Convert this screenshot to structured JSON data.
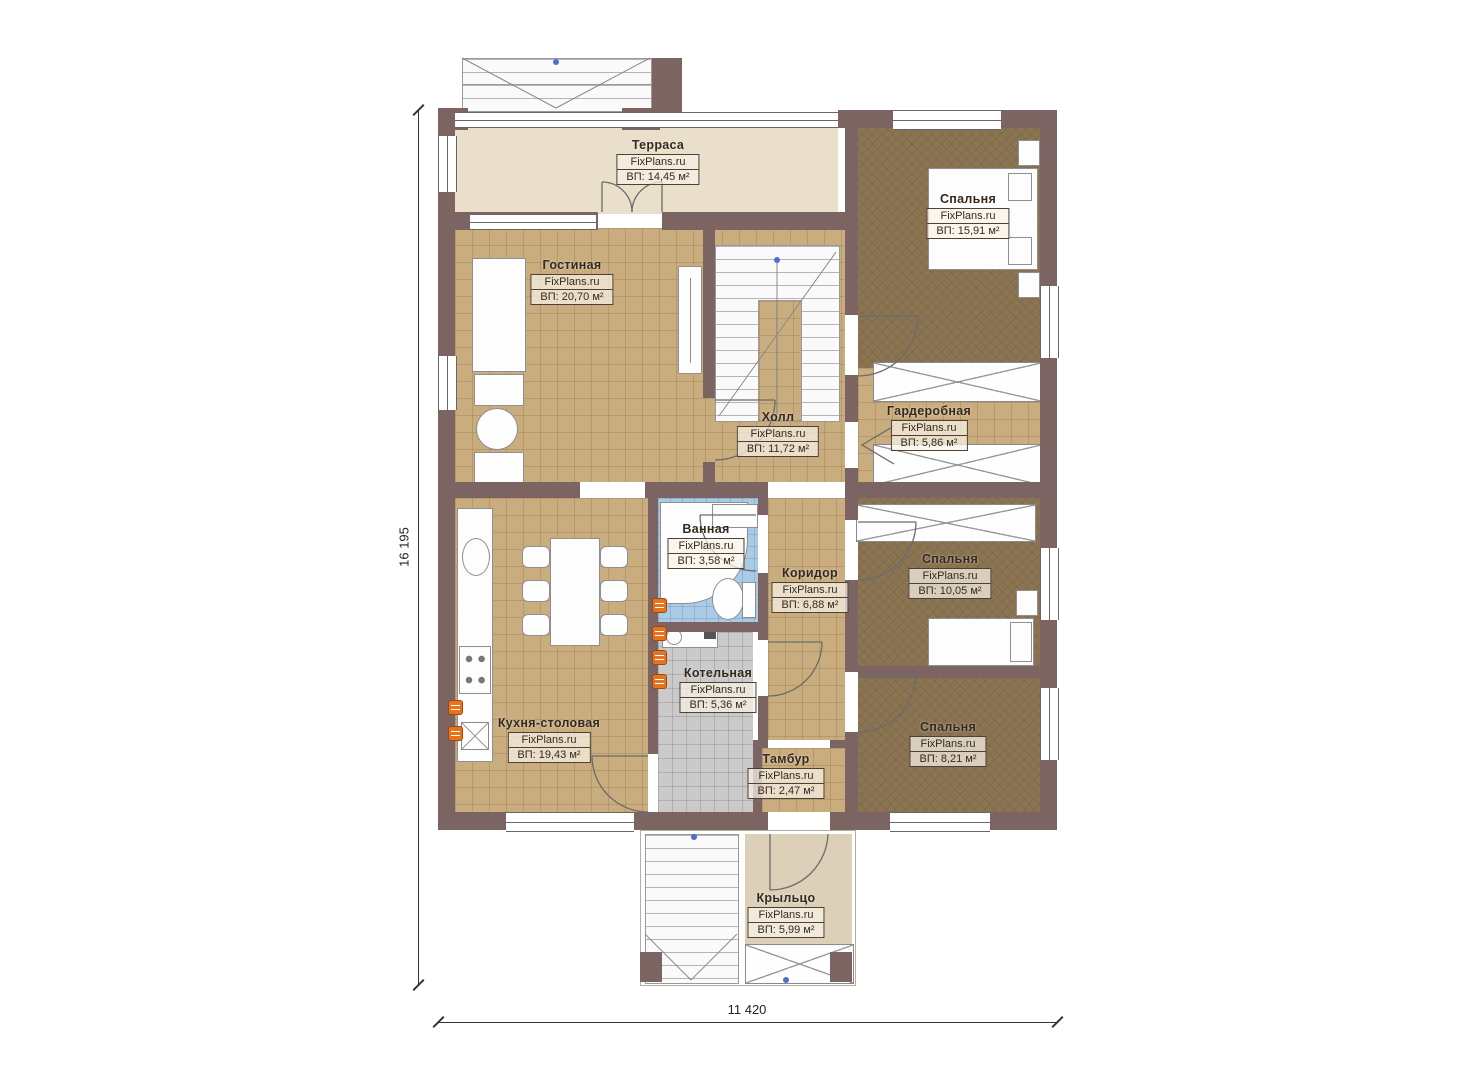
{
  "plan": {
    "brand": "FixPlans.ru",
    "dimensions": {
      "vertical": "16 195",
      "horizontal": "11 420"
    },
    "rooms": [
      {
        "name": "Терраса",
        "watermark": "FixPlans.ru",
        "area": "ВП: 14,45 м²"
      },
      {
        "name": "Спальня",
        "watermark": "FixPlans.ru",
        "area": "ВП: 15,91 м²"
      },
      {
        "name": "Гостиная",
        "watermark": "FixPlans.ru",
        "area": "ВП: 20,70 м²"
      },
      {
        "name": "Холл",
        "watermark": "FixPlans.ru",
        "area": "ВП: 11,72 м²"
      },
      {
        "name": "Гардеробная",
        "watermark": "FixPlans.ru",
        "area": "ВП: 5,86 м²"
      },
      {
        "name": "Ванная",
        "watermark": "FixPlans.ru",
        "area": "ВП: 3,58 м²"
      },
      {
        "name": "Коридор",
        "watermark": "FixPlans.ru",
        "area": "ВП: 6,88 м²"
      },
      {
        "name": "Спальня",
        "watermark": "FixPlans.ru",
        "area": "ВП: 10,05 м²"
      },
      {
        "name": "Котельная",
        "watermark": "FixPlans.ru",
        "area": "ВП: 5,36 м²"
      },
      {
        "name": "Кухня-столовая",
        "watermark": "FixPlans.ru",
        "area": "ВП: 19,43 м²"
      },
      {
        "name": "Спальня",
        "watermark": "FixPlans.ru",
        "area": "ВП: 8,21 м²"
      },
      {
        "name": "Тамбур",
        "watermark": "FixPlans.ru",
        "area": "ВП: 2,47 м²"
      },
      {
        "name": "Крыльцо",
        "watermark": "FixPlans.ru",
        "area": "ВП: 5,99 м²"
      }
    ],
    "colors": {
      "wall": "#7c6463",
      "floor_tile": "#c9ad7e",
      "floor_carpet": "#8b7452",
      "floor_bath": "#a9cbe6",
      "floor_boiler": "#cacaca",
      "floor_terrace": "#e9dfca",
      "floor_porch": "#ddd0b8",
      "radiator": "#e8731e"
    }
  }
}
